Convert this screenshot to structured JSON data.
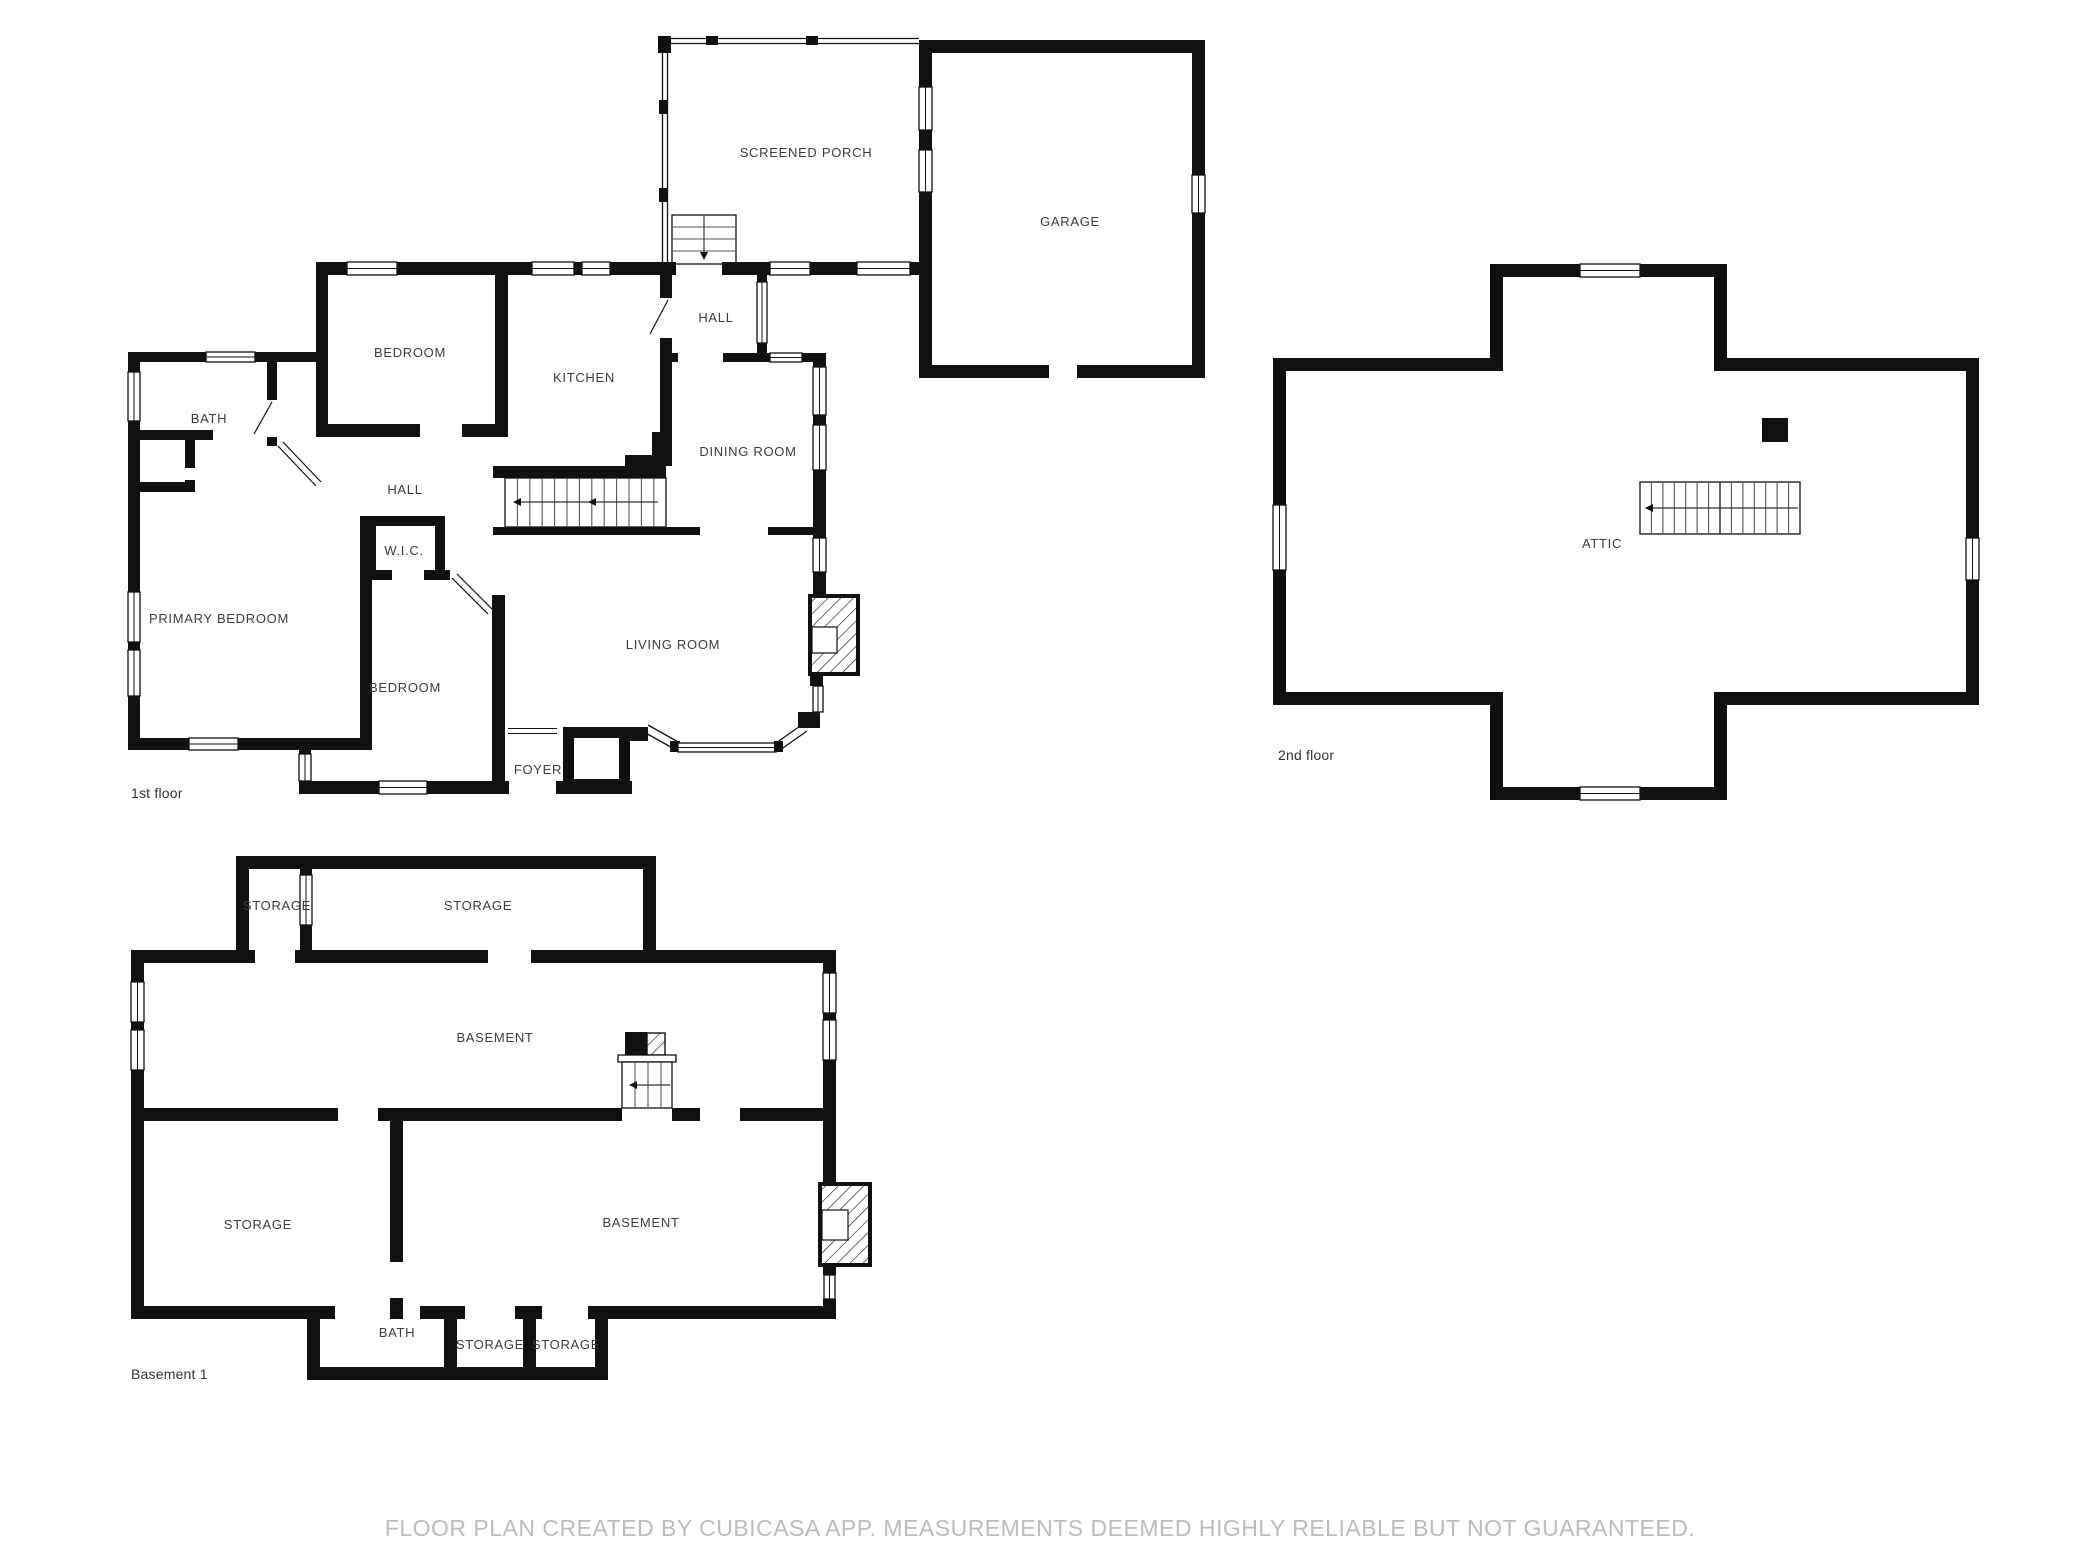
{
  "footer": {
    "disclaimer": "FLOOR PLAN CREATED BY CUBICASA APP. MEASUREMENTS DEEMED HIGHLY RELIABLE BUT NOT GUARANTEED."
  },
  "floor1": {
    "caption": "1st floor",
    "rooms": {
      "screened_porch": "SCREENED PORCH",
      "garage": "GARAGE",
      "hall_upper": "HALL",
      "bedroom_top": "BEDROOM",
      "kitchen": "KITCHEN",
      "dining_room": "DINING ROOM",
      "bath": "BATH",
      "hall": "HALL",
      "wic": "W.I.C.",
      "primary_bedroom": "PRIMARY BEDROOM",
      "bedroom_bottom": "BEDROOM",
      "living_room": "LIVING ROOM",
      "foyer": "FOYER"
    }
  },
  "floor2": {
    "caption": "2nd floor",
    "rooms": {
      "attic": "ATTIC"
    }
  },
  "basement": {
    "caption": "Basement 1",
    "rooms": {
      "storage_small_top": "STORAGE",
      "storage_large_top": "STORAGE",
      "basement_main": "BASEMENT",
      "storage_left": "STORAGE",
      "basement_lower": "BASEMENT",
      "bath": "BATH",
      "storage_bottom_left": "STORAGE",
      "storage_bottom_right": "STORAGE"
    }
  },
  "colors": {
    "wall": "#111111",
    "label": "#3c3c3c",
    "footer_text": "#bcbcbc"
  }
}
